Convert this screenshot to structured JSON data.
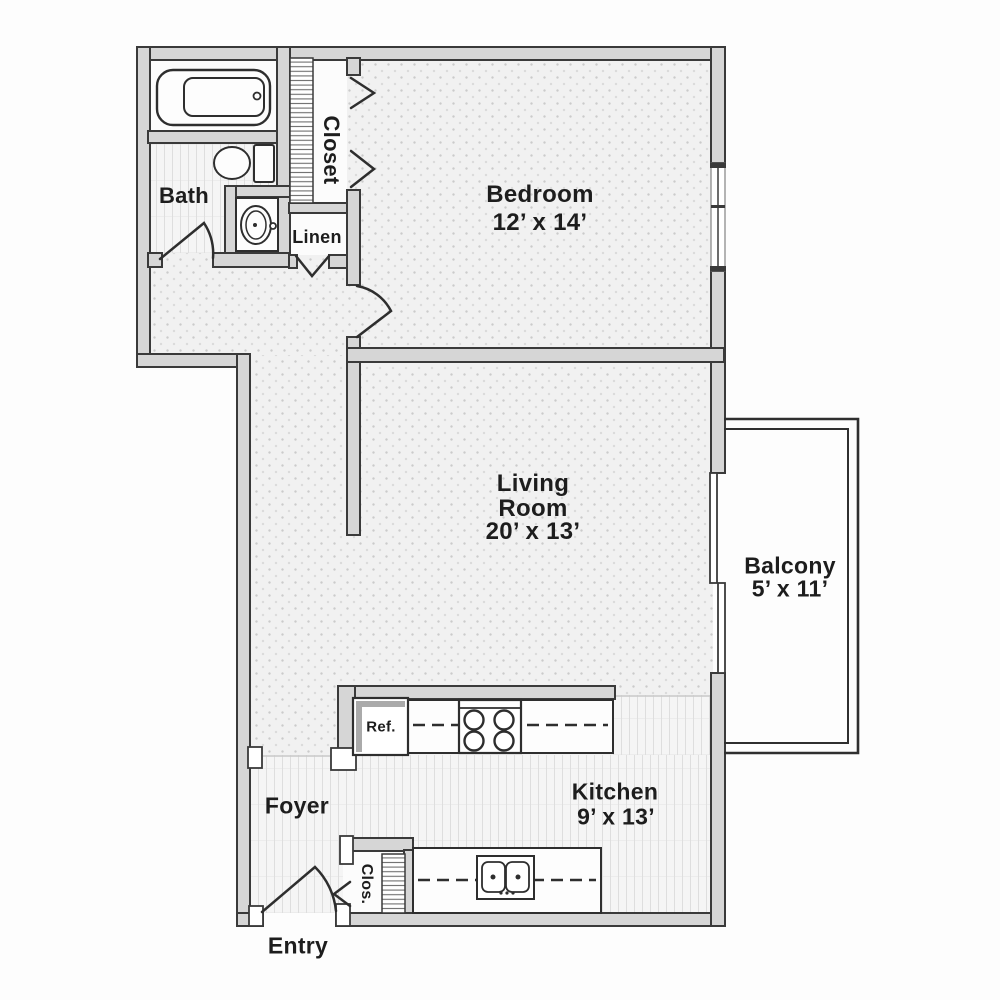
{
  "colors": {
    "wall_fill": "#d6d6d6",
    "wall_outline": "#3a3a3a",
    "fixture_stroke": "#2e2e2e",
    "floor_dotted": "#f1f1f1",
    "floor_striped": "#f5f5f5",
    "text": "#1d1d1d"
  },
  "rooms": {
    "bath": {
      "label": "Bath"
    },
    "closet": {
      "label": "Closet"
    },
    "linen": {
      "label": "Linen"
    },
    "bedroom": {
      "label": "Bedroom",
      "dims": "12’ x 14’"
    },
    "living_room": {
      "label_line_1": "Living",
      "label_line_2": "Room",
      "dims": "20’ x 13’"
    },
    "balcony": {
      "label": "Balcony",
      "dims": "5’ x 11’"
    },
    "kitchen": {
      "label": "Kitchen",
      "dims": "9’ x 13’"
    },
    "foyer": {
      "label": "Foyer"
    },
    "entry": {
      "label": "Entry"
    },
    "small_closet": {
      "label": "Clos."
    }
  },
  "fixtures": {
    "refrigerator_label": "Ref."
  }
}
